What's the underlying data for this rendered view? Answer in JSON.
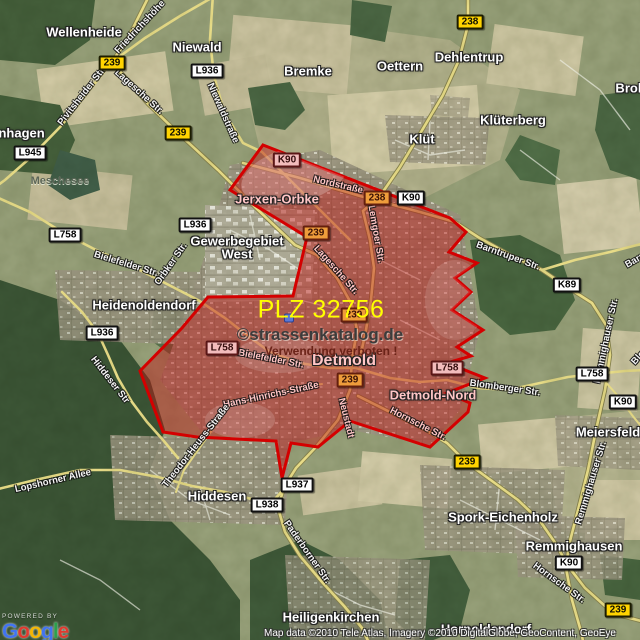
{
  "overlay": {
    "plz_label": "PLZ 32756",
    "watermark": "©strassenkatalog.de",
    "warning": "Verwendung verboten !"
  },
  "attribution": {
    "powered_by": "POWERED BY",
    "copyright": "Map data ©2010 Tele Atlas, Imagery ©2010 DigitalGlobe, GeoContent, GeoEye",
    "logo_letters": [
      {
        "ch": "G",
        "color": "#4274f0"
      },
      {
        "ch": "o",
        "color": "#e03a2f"
      },
      {
        "ch": "o",
        "color": "#f3b605"
      },
      {
        "ch": "g",
        "color": "#4274f0"
      },
      {
        "ch": "l",
        "color": "#2ba14c"
      },
      {
        "ch": "e",
        "color": "#e03a2f"
      }
    ]
  },
  "colors": {
    "plz_yellow": "#ffff00",
    "area_border": "#d40000",
    "area_fill": "rgba(196,18,18,0.44)",
    "shield_yellow": "#ffd300"
  },
  "map": {
    "place_labels": [
      {
        "text": "enhagen",
        "x": 18,
        "y": 133
      },
      {
        "text": "Wellenheide",
        "x": 84,
        "y": 32
      },
      {
        "text": "Niewald",
        "x": 197,
        "y": 47
      },
      {
        "text": "Bremke",
        "x": 308,
        "y": 71
      },
      {
        "text": "Oettern",
        "x": 400,
        "y": 66
      },
      {
        "text": "Dehlentrup",
        "x": 469,
        "y": 57
      },
      {
        "text": "Klüterberg",
        "x": 513,
        "y": 120
      },
      {
        "text": "Klüt",
        "x": 422,
        "y": 139
      },
      {
        "text": "Brokhausen",
        "x": 653,
        "y": 88
      },
      {
        "text": "Jerxen-Orbke",
        "x": 277,
        "y": 199,
        "cls": "tint"
      },
      {
        "text": "Gewerbegebiet",
        "x": 237,
        "y": 241
      },
      {
        "text": "West",
        "x": 237,
        "y": 254
      },
      {
        "text": "Heidenoldendorf",
        "x": 144,
        "y": 305
      },
      {
        "text": "Detmold",
        "x": 344,
        "y": 361,
        "cls": "city tint"
      },
      {
        "text": "Detmold-Nord",
        "x": 433,
        "y": 395,
        "cls": "tint"
      },
      {
        "text": "Hiddesen",
        "x": 217,
        "y": 496
      },
      {
        "text": "Meiersfeld",
        "x": 608,
        "y": 432
      },
      {
        "text": "Spork-Eichenholz",
        "x": 503,
        "y": 517
      },
      {
        "text": "Remmighausen",
        "x": 574,
        "y": 546
      },
      {
        "text": "Heiligenkirchen",
        "x": 331,
        "y": 617
      },
      {
        "text": "Hornoldendorf",
        "x": 486,
        "y": 629
      },
      {
        "text": "Meschesee",
        "x": 60,
        "y": 181,
        "cls": "lake"
      }
    ],
    "street_labels": [
      {
        "text": "Friedrichshöhe",
        "x": 140,
        "y": 27,
        "r": -47
      },
      {
        "text": "Pivitsheider Str.",
        "x": 82,
        "y": 96,
        "r": -52
      },
      {
        "text": "Lagesche Str.",
        "x": 139,
        "y": 92,
        "r": 42
      },
      {
        "text": "Niewaldstraße",
        "x": 223,
        "y": 113,
        "r": 66
      },
      {
        "text": "Nordstraße",
        "x": 338,
        "y": 185,
        "r": 13,
        "tint": true
      },
      {
        "text": "Lemgoer Str.",
        "x": 376,
        "y": 234,
        "r": 80,
        "tint": true
      },
      {
        "text": "Lagesche Str.",
        "x": 336,
        "y": 270,
        "r": 48,
        "tint": true
      },
      {
        "text": "Orbker Str.",
        "x": 171,
        "y": 264,
        "r": -55
      },
      {
        "text": "Bielefelder Str.",
        "x": 126,
        "y": 264,
        "r": 17
      },
      {
        "text": "Bielefelder Str.",
        "x": 271,
        "y": 359,
        "r": 11,
        "tint": true
      },
      {
        "text": "Hans-Hinrichs-Straße",
        "x": 271,
        "y": 395,
        "r": -12,
        "tint": true
      },
      {
        "text": "Theodor-Heuss-Straße",
        "x": 196,
        "y": 446,
        "r": -52
      },
      {
        "text": "Hiddeser Str",
        "x": 110,
        "y": 380,
        "r": 52
      },
      {
        "text": "Neustadt",
        "x": 346,
        "y": 418,
        "r": 76,
        "tint": true
      },
      {
        "text": "Hornsche Str.",
        "x": 418,
        "y": 424,
        "r": 27,
        "tint": true
      },
      {
        "text": "Barntruper Str.",
        "x": 508,
        "y": 256,
        "r": 20
      },
      {
        "text": "Barntruper Str.",
        "x": 655,
        "y": 249,
        "r": -30
      },
      {
        "text": "Remmighauser Str.",
        "x": 606,
        "y": 341,
        "r": -78
      },
      {
        "text": "Remmighauser Str.",
        "x": 591,
        "y": 483,
        "r": -73
      },
      {
        "text": "Blomberger Str.",
        "x": 505,
        "y": 388,
        "r": 8
      },
      {
        "text": "Blomberger Str.",
        "x": 657,
        "y": 337,
        "r": -48
      },
      {
        "text": "Paderborner Str.",
        "x": 307,
        "y": 552,
        "r": 55
      },
      {
        "text": "Lopshorner Allee",
        "x": 53,
        "y": 481,
        "r": -13
      },
      {
        "text": "Hornsche Str.",
        "x": 559,
        "y": 583,
        "r": 36
      }
    ],
    "shields": [
      {
        "text": "239",
        "x": 112,
        "y": 63,
        "type": "b"
      },
      {
        "text": "L936",
        "x": 207,
        "y": 71,
        "type": "w"
      },
      {
        "text": "238",
        "x": 470,
        "y": 22,
        "type": "b"
      },
      {
        "text": "239",
        "x": 178,
        "y": 133,
        "type": "b"
      },
      {
        "text": "L945",
        "x": 30,
        "y": 153,
        "type": "w"
      },
      {
        "text": "K90",
        "x": 287,
        "y": 160,
        "type": "w",
        "tint": true
      },
      {
        "text": "238",
        "x": 377,
        "y": 198,
        "type": "b",
        "tint": true
      },
      {
        "text": "K90",
        "x": 411,
        "y": 198,
        "type": "w"
      },
      {
        "text": "L936",
        "x": 195,
        "y": 225,
        "type": "w"
      },
      {
        "text": "L758",
        "x": 65,
        "y": 235,
        "type": "w"
      },
      {
        "text": "239",
        "x": 316,
        "y": 233,
        "type": "b",
        "tint": true
      },
      {
        "text": "K89",
        "x": 567,
        "y": 285,
        "type": "w"
      },
      {
        "text": "239",
        "x": 354,
        "y": 315,
        "type": "b",
        "tint": true
      },
      {
        "text": "L936",
        "x": 102,
        "y": 333,
        "type": "w"
      },
      {
        "text": "L758",
        "x": 222,
        "y": 348,
        "type": "w",
        "tint": true
      },
      {
        "text": "L758",
        "x": 447,
        "y": 368,
        "type": "w",
        "tint": true
      },
      {
        "text": "L758",
        "x": 592,
        "y": 374,
        "type": "w"
      },
      {
        "text": "239",
        "x": 350,
        "y": 380,
        "type": "b",
        "tint": true
      },
      {
        "text": "K90",
        "x": 623,
        "y": 402,
        "type": "w"
      },
      {
        "text": "239",
        "x": 467,
        "y": 462,
        "type": "b"
      },
      {
        "text": "L937",
        "x": 297,
        "y": 485,
        "type": "w"
      },
      {
        "text": "L938",
        "x": 267,
        "y": 505,
        "type": "w"
      },
      {
        "text": "K90",
        "x": 569,
        "y": 563,
        "type": "w"
      },
      {
        "text": "239",
        "x": 618,
        "y": 610,
        "type": "b"
      }
    ]
  }
}
